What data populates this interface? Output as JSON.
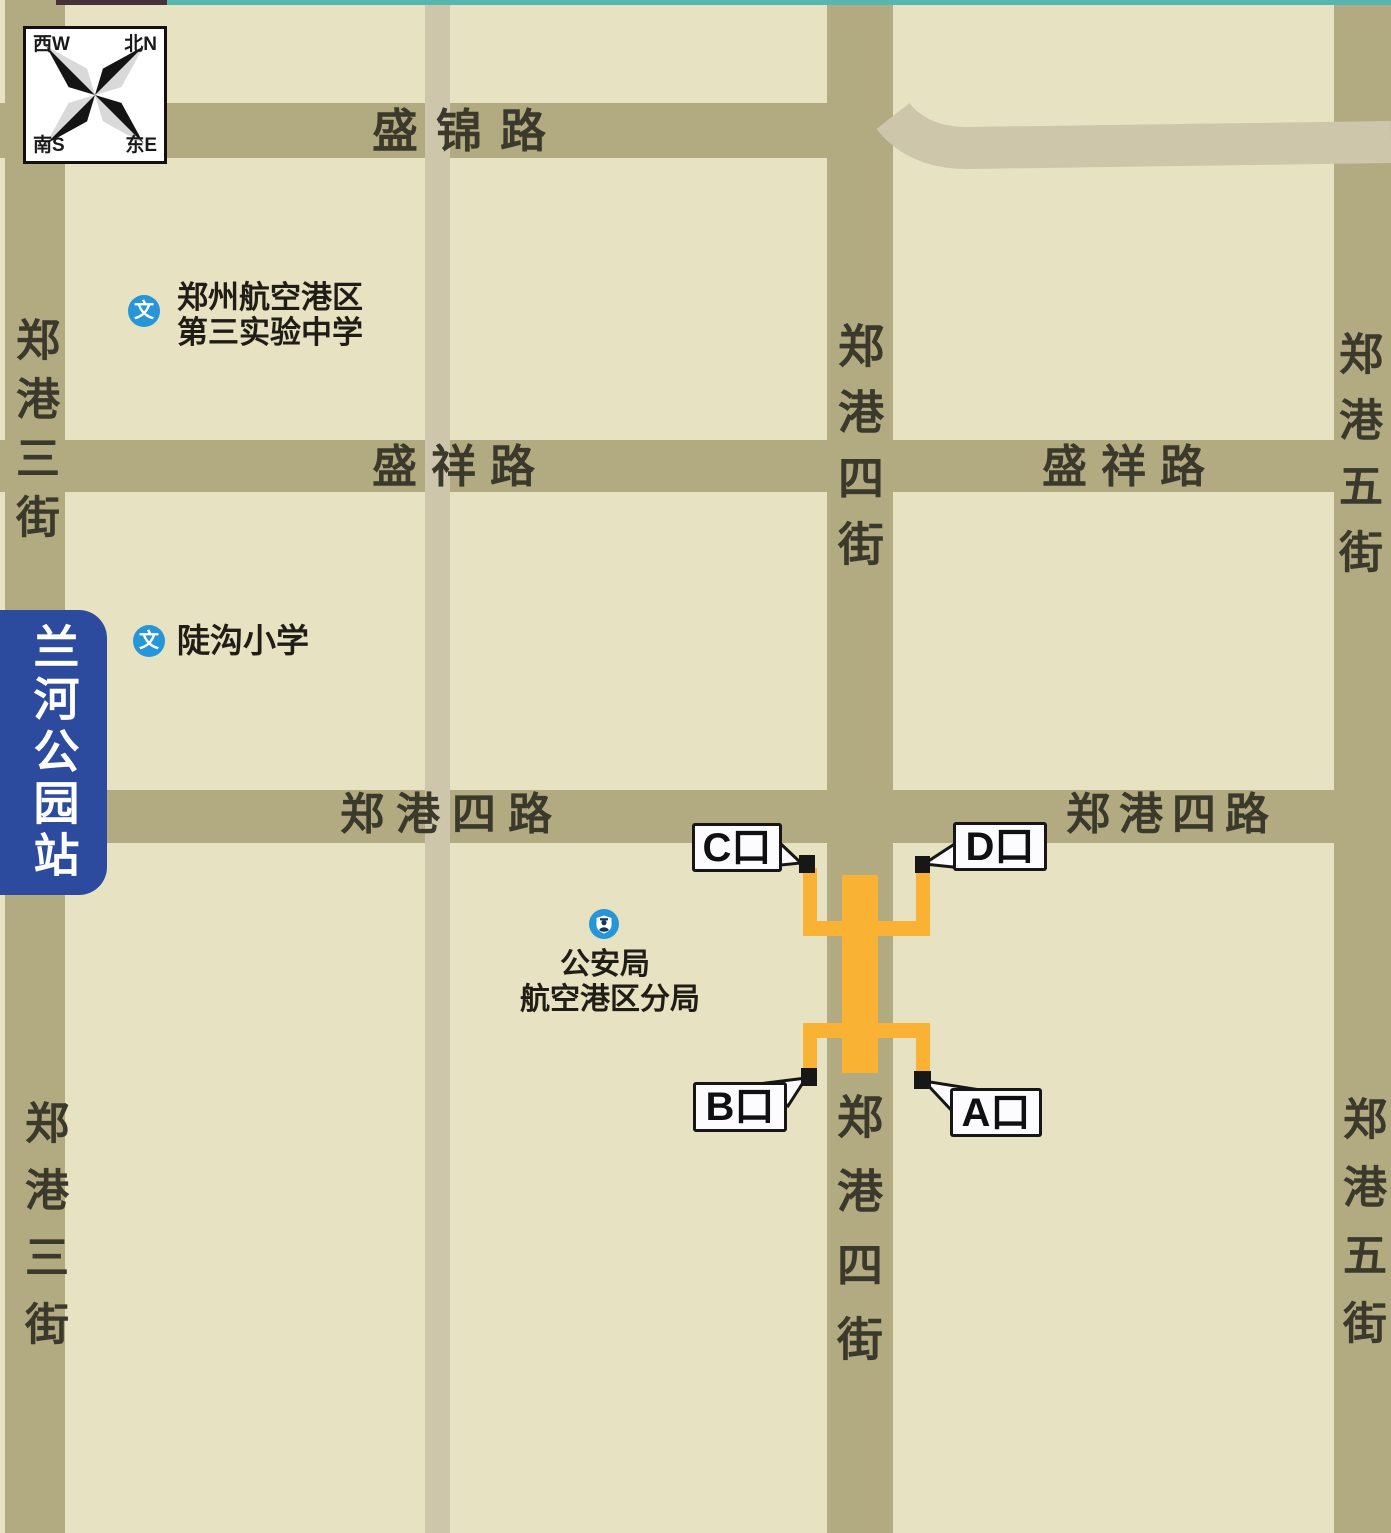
{
  "banner": {
    "station_name": "兰河公园站"
  },
  "compass": {
    "west": "西W",
    "north": "北N",
    "south": "南S",
    "east": "东E"
  },
  "roads": {
    "shengjin_lu": "盛锦路",
    "shengxiang_lu": "盛祥路",
    "zhenggang_si_lu": "郑港四路",
    "zhenggang_san_jie": "郑港三街",
    "zhenggang_si_jie": "郑港四街",
    "zhenggang_wu_jie": "郑港五街"
  },
  "pois": {
    "school_icon_glyph": "文",
    "zhengzhou_airport_no3_school": {
      "line1": "郑州航空港区",
      "line2": "第三实验中学"
    },
    "dougou_primary_school": {
      "label": "陡沟小学"
    },
    "police_branch": {
      "line1": "公安局",
      "line2": "航空港区分局"
    }
  },
  "exits": {
    "a": "A口",
    "b": "B口",
    "c": "C口",
    "d": "D口"
  },
  "colors": {
    "background": "#e7e2c1",
    "road_main": "#b2aa80",
    "road_minor": "#cdc6ab",
    "station_line_yellow": "#f9b233",
    "exit_marker_black": "#171717",
    "banner_blue": "#2c4b9e",
    "poi_icon_blue": "#2796d8",
    "top_edge_teal": "#57b7ae",
    "road_label": "#3b392b"
  }
}
